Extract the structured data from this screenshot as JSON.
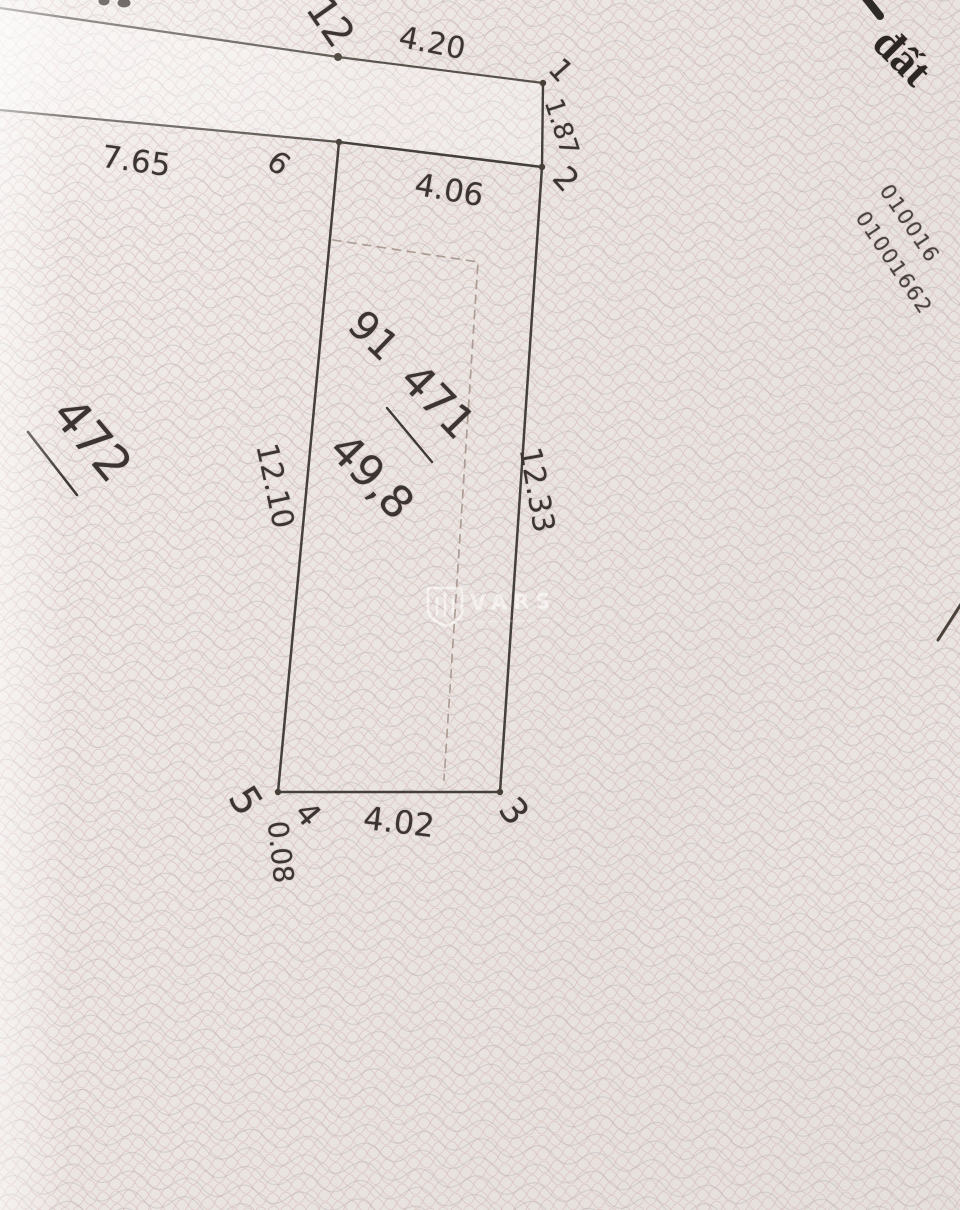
{
  "corner_text": "đất",
  "serial_numbers": {
    "line1": "010016",
    "line2": "01001662"
  },
  "parcels": {
    "main": {
      "code": "91",
      "number": "471",
      "area": "49,8"
    },
    "adjacent": {
      "number": "472"
    }
  },
  "vertices": {
    "p12": "12",
    "p1": "1",
    "p2": "2",
    "p3": "3",
    "p4": "4",
    "p5": "5",
    "p6": "6"
  },
  "dimensions": {
    "road_top": "4.20",
    "east_top": "1.87",
    "north": "4.06",
    "east": "12.33",
    "south": "4.02",
    "southwest_step": "0.08",
    "west": "12.10",
    "road_left": "7.65"
  },
  "watermark": {
    "text": "VARS"
  }
}
